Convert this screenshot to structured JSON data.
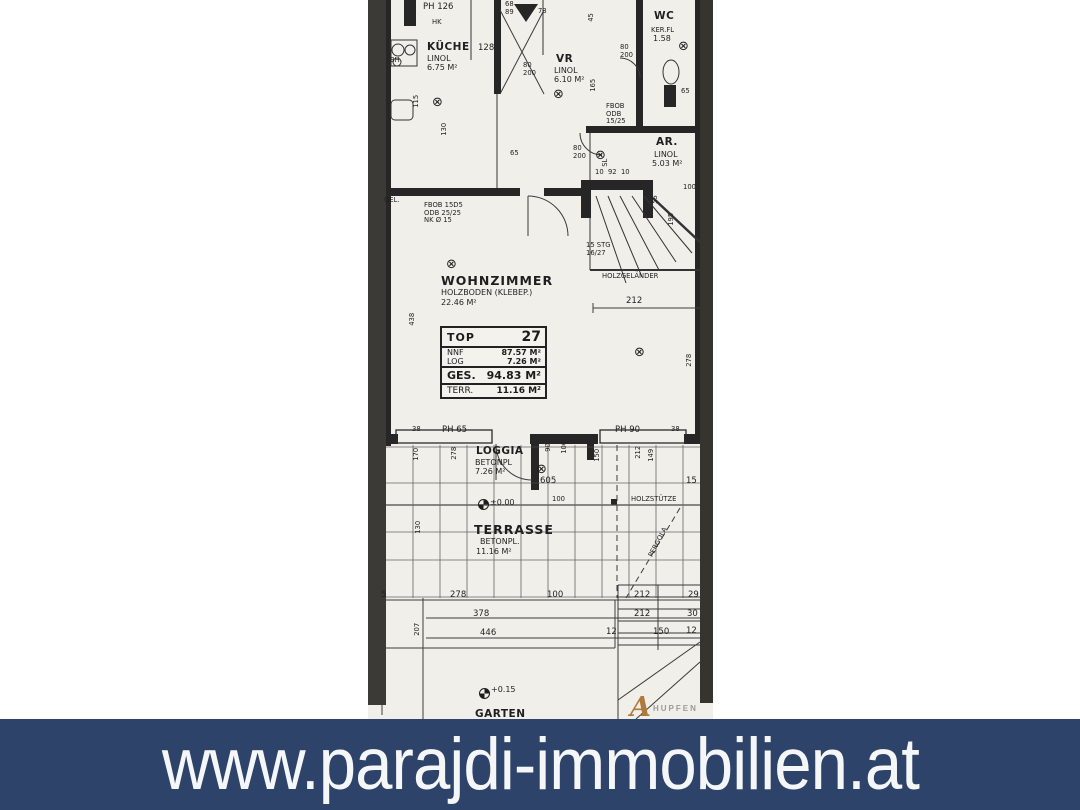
{
  "banner": {
    "url_text": "www.parajdi-immobilien.at",
    "bg_color": "#2e4369",
    "text_color": "#f5f6f8"
  },
  "plan": {
    "paper_color": "#f1efe9",
    "ink_color": "#262626",
    "info_table": {
      "rows": [
        {
          "label": "TOP",
          "value": "27",
          "cls": "r-top"
        },
        {
          "label": "NNF",
          "value": "87.57 M²",
          "cls": "r-nnf"
        },
        {
          "label": "LOG",
          "value": "7.26 M²",
          "cls": "r-log"
        },
        {
          "label": "GES.",
          "value": "94.83 M²",
          "cls": "r-ges"
        },
        {
          "label": "TERR.",
          "value": "11.16 M²",
          "cls": "r-terr"
        }
      ],
      "sections": [
        [
          "r-top"
        ],
        [
          "r-nnf",
          "r-log"
        ],
        [
          "r-ges"
        ],
        [
          "r-terr"
        ]
      ]
    },
    "labels": [
      {
        "t": "PH 126",
        "x": 55,
        "y": 3,
        "c": "dim"
      },
      {
        "t": "HK",
        "x": 64,
        "y": 19,
        "c": "tiny"
      },
      {
        "t": "68\n89",
        "x": 137,
        "y": 1,
        "c": "tiny"
      },
      {
        "t": "73",
        "x": 170,
        "y": 8,
        "c": "tiny"
      },
      {
        "t": "BH",
        "x": 22,
        "y": 57,
        "c": "tiny"
      },
      {
        "t": "KÜCHE",
        "x": 59,
        "y": 42,
        "c": "room"
      },
      {
        "t": "LINOL",
        "x": 59,
        "y": 55,
        "c": "sub"
      },
      {
        "t": "6.75 M²",
        "x": 59,
        "y": 64,
        "c": "sub"
      },
      {
        "t": "128",
        "x": 110,
        "y": 44,
        "c": "dim"
      },
      {
        "t": "VR",
        "x": 188,
        "y": 54,
        "c": "room"
      },
      {
        "t": "LINOL",
        "x": 186,
        "y": 67,
        "c": "sub"
      },
      {
        "t": "6.10 M²",
        "x": 186,
        "y": 76,
        "c": "sub"
      },
      {
        "t": "WC",
        "x": 286,
        "y": 11,
        "c": "room"
      },
      {
        "t": "KER.FL",
        "x": 283,
        "y": 27,
        "c": "tiny"
      },
      {
        "t": "1.58",
        "x": 285,
        "y": 35,
        "c": "sub"
      },
      {
        "t": "80\n200",
        "x": 252,
        "y": 44,
        "c": "tiny"
      },
      {
        "t": "45",
        "x": 224,
        "y": 18,
        "c": "tiny",
        "r": -90
      },
      {
        "t": "165",
        "x": 226,
        "y": 88,
        "c": "tiny",
        "r": -90
      },
      {
        "t": "80\n200",
        "x": 155,
        "y": 62,
        "c": "tiny"
      },
      {
        "t": "FBOB\nODB\n15/25",
        "x": 238,
        "y": 103,
        "c": "tiny"
      },
      {
        "t": "65",
        "x": 313,
        "y": 88,
        "c": "tiny"
      },
      {
        "t": "AR.",
        "x": 288,
        "y": 137,
        "c": "room"
      },
      {
        "t": "LINOL",
        "x": 286,
        "y": 151,
        "c": "sub"
      },
      {
        "t": "5.03 M²",
        "x": 284,
        "y": 160,
        "c": "sub"
      },
      {
        "t": "80\n200",
        "x": 205,
        "y": 145,
        "c": "tiny"
      },
      {
        "t": "SL",
        "x": 238,
        "y": 163,
        "c": "tiny",
        "r": -90
      },
      {
        "t": "115",
        "x": 49,
        "y": 104,
        "c": "tiny",
        "r": -90
      },
      {
        "t": "130",
        "x": 77,
        "y": 132,
        "c": "tiny",
        "r": -90
      },
      {
        "t": "65",
        "x": 142,
        "y": 150,
        "c": "tiny"
      },
      {
        "t": "GEL.",
        "x": 16,
        "y": 197,
        "c": "tiny"
      },
      {
        "t": "FBOB 15D5\nODB 25/25\nNK Ø 15",
        "x": 56,
        "y": 202,
        "c": "tiny"
      },
      {
        "t": "10  92  10",
        "x": 227,
        "y": 169,
        "c": "tiny"
      },
      {
        "t": "100",
        "x": 315,
        "y": 184,
        "c": "tiny"
      },
      {
        "t": "55",
        "x": 288,
        "y": 200,
        "c": "tiny",
        "r": -90
      },
      {
        "t": "195",
        "x": 304,
        "y": 222,
        "c": "tiny",
        "r": -90
      },
      {
        "t": "15 STG\n16/27",
        "x": 218,
        "y": 242,
        "c": "tiny"
      },
      {
        "t": "HOLZGELÄNDER",
        "x": 234,
        "y": 273,
        "c": "tiny"
      },
      {
        "t": "WOHNZIMMER",
        "x": 73,
        "y": 274,
        "c": "big"
      },
      {
        "t": "HOLZBODEN (KLEBEP.)",
        "x": 73,
        "y": 289,
        "c": "sub"
      },
      {
        "t": "22.46 M²",
        "x": 73,
        "y": 299,
        "c": "sub"
      },
      {
        "t": "438",
        "x": 45,
        "y": 322,
        "c": "tiny",
        "r": -90
      },
      {
        "t": "212",
        "x": 258,
        "y": 297,
        "c": "dim"
      },
      {
        "t": "278",
        "x": 322,
        "y": 363,
        "c": "tiny",
        "r": -90
      },
      {
        "t": "38",
        "x": 44,
        "y": 426,
        "c": "tiny"
      },
      {
        "t": "PH 65",
        "x": 74,
        "y": 426,
        "c": "dim"
      },
      {
        "t": "PH 90",
        "x": 247,
        "y": 426,
        "c": "dim"
      },
      {
        "t": "38",
        "x": 303,
        "y": 426,
        "c": "tiny"
      },
      {
        "t": "LOGGIA",
        "x": 108,
        "y": 446,
        "c": "room"
      },
      {
        "t": "BETONPL",
        "x": 107,
        "y": 459,
        "c": "sub"
      },
      {
        "t": "7.26 M²",
        "x": 107,
        "y": 468,
        "c": "sub"
      },
      {
        "t": "170",
        "x": 49,
        "y": 457,
        "c": "tiny",
        "r": -90
      },
      {
        "t": "278",
        "x": 87,
        "y": 456,
        "c": "tiny",
        "r": -90
      },
      {
        "t": "90",
        "x": 181,
        "y": 448,
        "c": "tiny",
        "r": -90
      },
      {
        "t": "100",
        "x": 197,
        "y": 450,
        "c": "tiny",
        "r": -90
      },
      {
        "t": "605",
        "x": 172,
        "y": 477,
        "c": "dim"
      },
      {
        "t": "150",
        "x": 230,
        "y": 458,
        "c": "tiny",
        "r": -90
      },
      {
        "t": "212",
        "x": 271,
        "y": 455,
        "c": "tiny",
        "r": -90
      },
      {
        "t": "149",
        "x": 284,
        "y": 458,
        "c": "tiny",
        "r": -90
      },
      {
        "t": "15",
        "x": 318,
        "y": 477,
        "c": "dim"
      },
      {
        "t": "100",
        "x": 184,
        "y": 496,
        "c": "tiny"
      },
      {
        "t": "±0.00",
        "x": 122,
        "y": 499,
        "c": "sub"
      },
      {
        "t": "HOLZSTÜTZE",
        "x": 263,
        "y": 496,
        "c": "tiny"
      },
      {
        "t": "130",
        "x": 51,
        "y": 530,
        "c": "tiny",
        "r": -90
      },
      {
        "t": "TERRASSE",
        "x": 106,
        "y": 523,
        "c": "big"
      },
      {
        "t": "BETONPL.",
        "x": 112,
        "y": 538,
        "c": "sub"
      },
      {
        "t": "11.16 M²",
        "x": 108,
        "y": 548,
        "c": "sub"
      },
      {
        "t": "PERGOLA",
        "x": 283,
        "y": 553,
        "c": "tiny",
        "r": -62
      },
      {
        "t": "5",
        "x": 13,
        "y": 591,
        "c": "dim"
      },
      {
        "t": "278",
        "x": 82,
        "y": 591,
        "c": "dim"
      },
      {
        "t": "100",
        "x": 179,
        "y": 591,
        "c": "dim"
      },
      {
        "t": "212",
        "x": 266,
        "y": 591,
        "c": "dim"
      },
      {
        "t": "29",
        "x": 320,
        "y": 591,
        "c": "dim"
      },
      {
        "t": "378",
        "x": 105,
        "y": 610,
        "c": "dim"
      },
      {
        "t": "212",
        "x": 266,
        "y": 610,
        "c": "dim"
      },
      {
        "t": "30",
        "x": 319,
        "y": 610,
        "c": "dim"
      },
      {
        "t": "207",
        "x": 50,
        "y": 632,
        "c": "tiny",
        "r": -90
      },
      {
        "t": "446",
        "x": 112,
        "y": 629,
        "c": "dim"
      },
      {
        "t": "12",
        "x": 238,
        "y": 628,
        "c": "dim"
      },
      {
        "t": "150",
        "x": 285,
        "y": 628,
        "c": "dim"
      },
      {
        "t": "12",
        "x": 318,
        "y": 627,
        "c": "dim"
      },
      {
        "t": "+0.15",
        "x": 123,
        "y": 686,
        "c": "sub"
      },
      {
        "t": "GARTEN",
        "x": 107,
        "y": 709,
        "c": "room"
      }
    ],
    "lamps": [
      {
        "x": 64,
        "y": 96
      },
      {
        "x": 185,
        "y": 88
      },
      {
        "x": 310,
        "y": 40
      },
      {
        "x": 227,
        "y": 149
      },
      {
        "x": 78,
        "y": 258
      },
      {
        "x": 266,
        "y": 346
      },
      {
        "x": 168,
        "y": 463
      }
    ],
    "level_markers": [
      {
        "x": 110,
        "y": 499
      },
      {
        "x": 111,
        "y": 688
      }
    ],
    "logo": {
      "letter": "A",
      "text": "HUPFEN"
    }
  }
}
